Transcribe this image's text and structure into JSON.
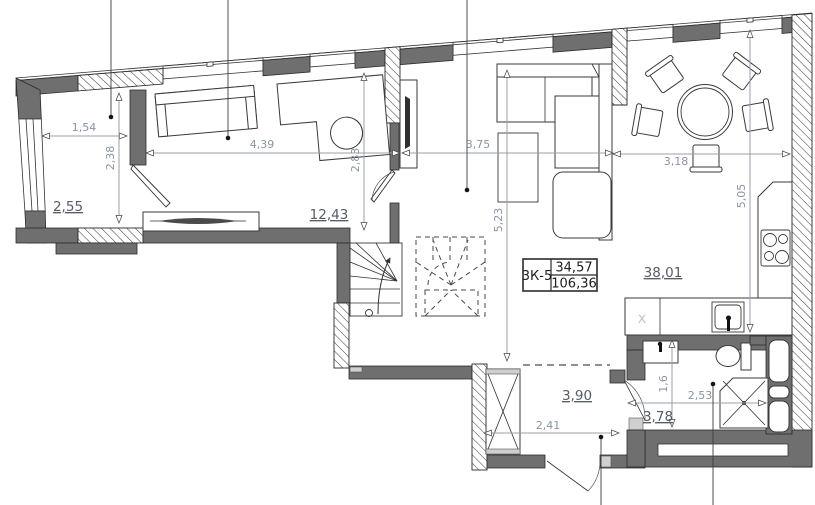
{
  "unit_tag": {
    "code": "3К-5",
    "upper": "34,57",
    "lower": "106,36"
  },
  "areas": {
    "storage": "2,55",
    "bedroom": "12,43",
    "living": "38,01",
    "hallway": "3,90",
    "bathroom": "3,78"
  },
  "dimensions": {
    "storage_w": "1,54",
    "storage_h": "2,38",
    "bedroom_w": "4,39",
    "bedroom_h": "2,83",
    "living_w": "3,75",
    "living_h": "5,23",
    "dining_w": "3,18",
    "kitchen_h": "5,05",
    "hallway_w": "2,41",
    "bathroom_h": "1,6",
    "bathroom_w": "2,53"
  },
  "markers": {
    "appliance": "х"
  },
  "colors": {
    "wall_fill": "#6f6f6f",
    "outline": "#2b2b2b",
    "dim_line": "#9aa1ab",
    "dim_text": "#8a94a2",
    "area_text": "#565d66"
  }
}
